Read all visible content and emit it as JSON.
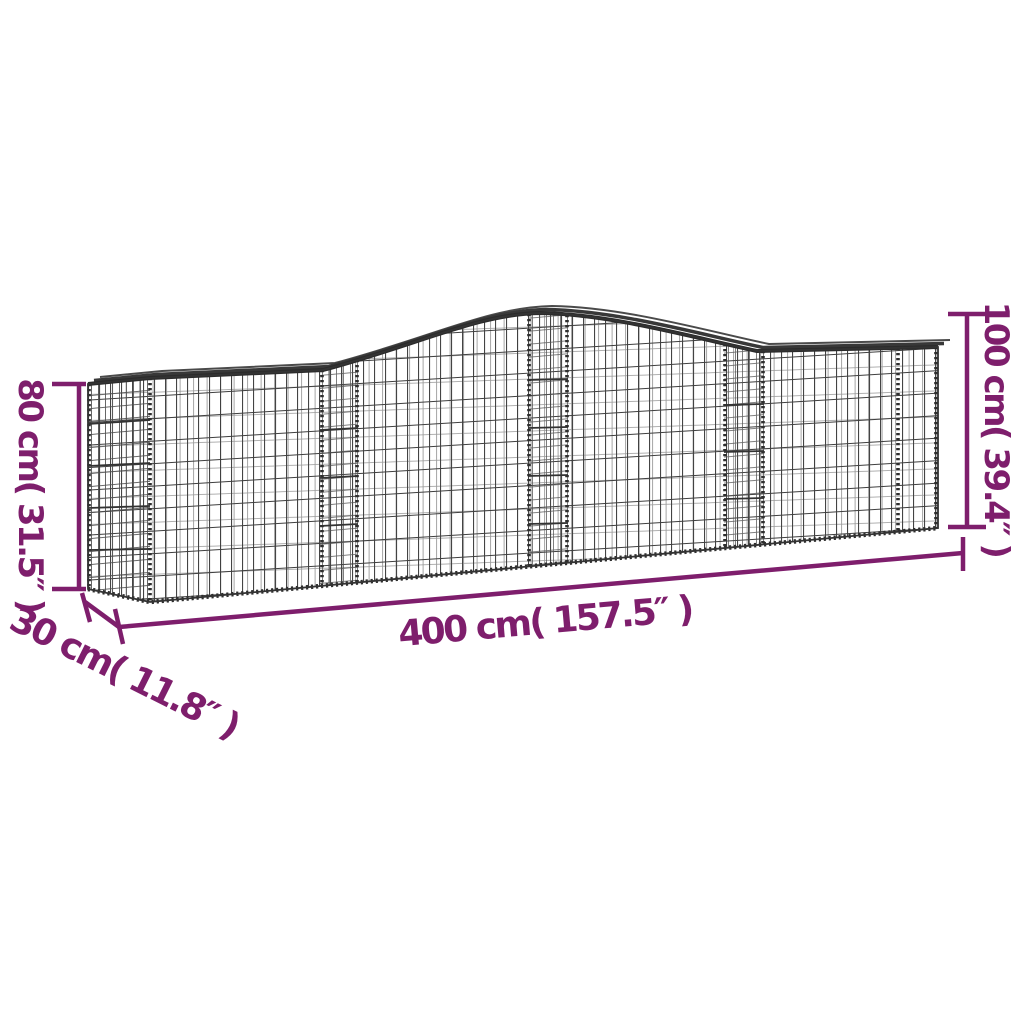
{
  "illustration": {
    "subject": "arched gabion wire mesh basket",
    "mesh_color": "#3E3E3E",
    "background": "#FFFFFF"
  },
  "annotations": {
    "color": "#7E1E6C",
    "height_left": "80 cm( 31.5″ )",
    "depth": "30 cm( 11.8″ )",
    "length": "400 cm( 157.5″ )",
    "height_right": "100 cm( 39.4″ )"
  }
}
